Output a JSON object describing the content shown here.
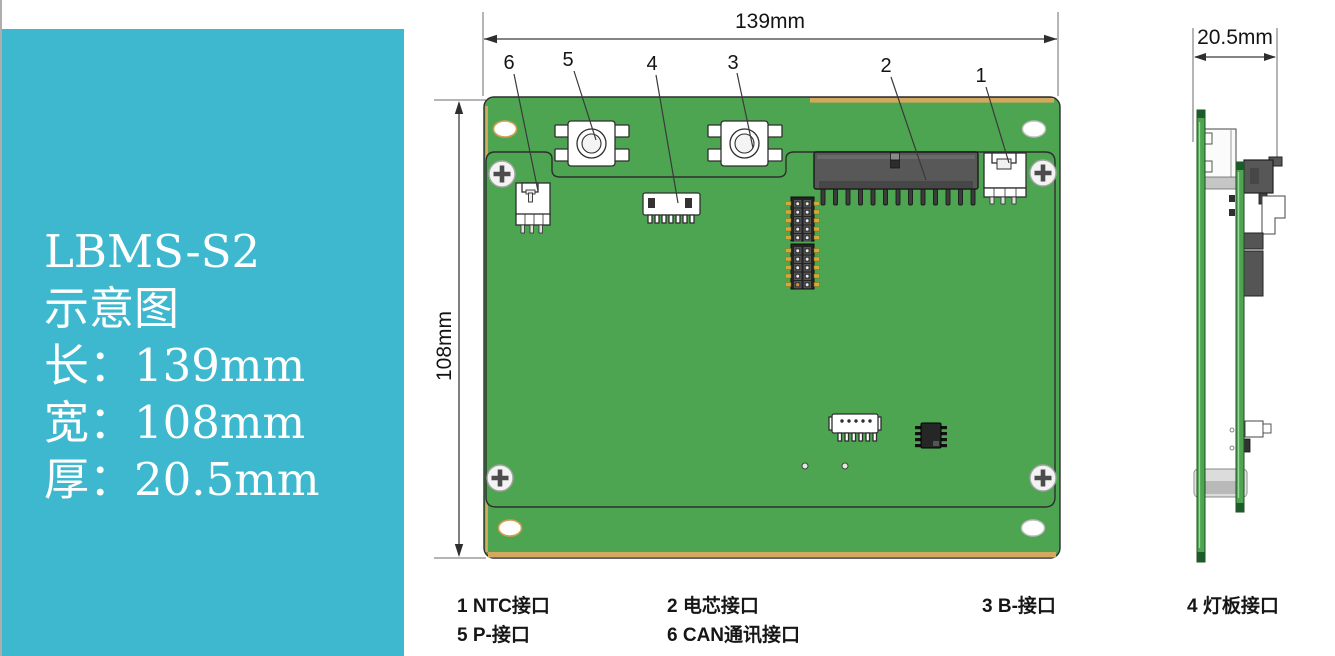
{
  "info_panel": {
    "bg_color": "#3eb8ce",
    "text_color": "#ffffff",
    "title": "LBMS-S2",
    "subtitle": "示意图",
    "lines": [
      {
        "label": "长：139mm"
      },
      {
        "label": "宽：108mm"
      },
      {
        "label": "厚：20.5mm"
      }
    ]
  },
  "front_view": {
    "board_color": "#4da551",
    "edge_color": "#d4a95f",
    "connector_dark_color": "#585858",
    "width_dim": "139mm",
    "height_dim": "108mm",
    "callouts": [
      {
        "num": "6"
      },
      {
        "num": "5"
      },
      {
        "num": "4"
      },
      {
        "num": "3"
      },
      {
        "num": "2"
      },
      {
        "num": "1"
      }
    ]
  },
  "side_view": {
    "thickness_dim": "20.5mm"
  },
  "legend": {
    "items": [
      {
        "label": "1 NTC接口"
      },
      {
        "label": "2 电芯接口"
      },
      {
        "label": "3 B-接口"
      },
      {
        "label": "4 灯板接口"
      },
      {
        "label": "5 P-接口"
      },
      {
        "label": "6 CAN通讯接口"
      }
    ]
  }
}
